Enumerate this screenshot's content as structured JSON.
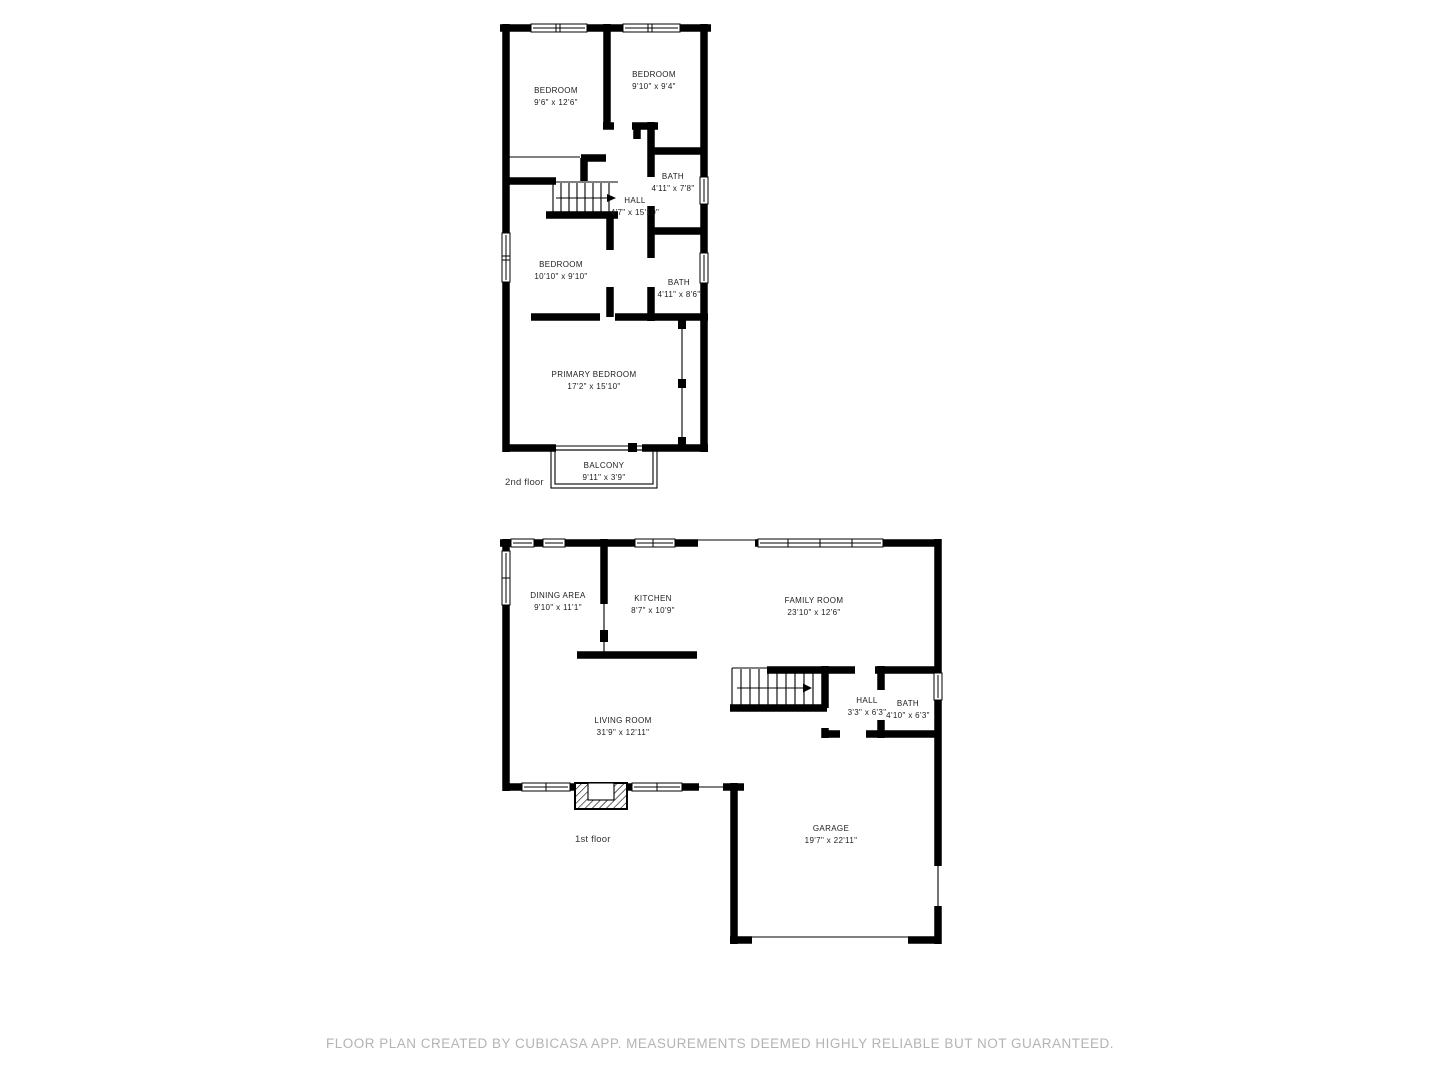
{
  "colors": {
    "wall": "#000000",
    "label": "#1c1c1c",
    "caption": "#353535",
    "footer": "#b4b4b4"
  },
  "icons": {
    "stair_direction_arrow": "→"
  },
  "floors": [
    {
      "caption": "2nd floor",
      "rooms": [
        {
          "name": "BEDROOM",
          "dims": "9'6\" x 12'6\""
        },
        {
          "name": "BEDROOM",
          "dims": "9'10\" x 9'4\""
        },
        {
          "name": "BATH",
          "dims": "4'11\" x 7'8\""
        },
        {
          "name": "HALL",
          "dims": "4'7\" x 15'10\""
        },
        {
          "name": "BEDROOM",
          "dims": "10'10\" x 9'10\""
        },
        {
          "name": "BATH",
          "dims": "4'11\" x 8'6\""
        },
        {
          "name": "PRIMARY BEDROOM",
          "dims": "17'2\" x 15'10\""
        },
        {
          "name": "BALCONY",
          "dims": "9'11\" x 3'9\""
        }
      ]
    },
    {
      "caption": "1st floor",
      "rooms": [
        {
          "name": "DINING AREA",
          "dims": "9'10\" x 11'1\""
        },
        {
          "name": "KITCHEN",
          "dims": "8'7\" x 10'9\""
        },
        {
          "name": "FAMILY ROOM",
          "dims": "23'10\" x 12'6\""
        },
        {
          "name": "LIVING ROOM",
          "dims": "31'9\" x 12'11\""
        },
        {
          "name": "HALL",
          "dims": "3'3\" x 6'3\""
        },
        {
          "name": "BATH",
          "dims": "4'10\" x 6'3\""
        },
        {
          "name": "GARAGE",
          "dims": "19'7\" x 22'11\""
        }
      ]
    }
  ],
  "footer": {
    "text": "FLOOR PLAN CREATED BY CUBICASA APP. MEASUREMENTS DEEMED HIGHLY RELIABLE BUT NOT GUARANTEED."
  }
}
